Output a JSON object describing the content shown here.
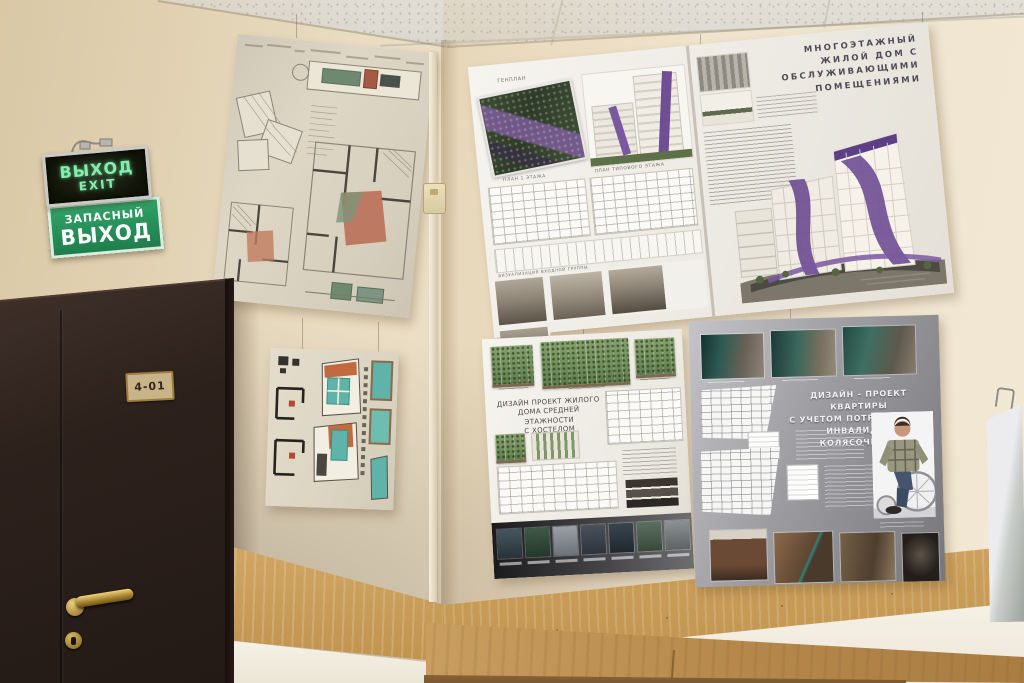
{
  "signs": {
    "exit_box": {
      "line1": "ВЫХОД",
      "line2": "EXIT"
    },
    "emergency": {
      "line1": "ЗАПАСНЫЙ",
      "line2": "ВЫХОД"
    }
  },
  "door": {
    "room_plate": "4-01"
  },
  "boards": {
    "residential": {
      "title_lines": [
        "МНОГОЭТАЖНЫЙ",
        "ЖИЛОЙ ДОМ С",
        "ОБСЛУЖИВАЮЩИМИ",
        "ПОМЕЩЕНИЯМИ"
      ],
      "labels": {
        "genplan": "ГЕНПЛАН",
        "plan_first": "ПЛАН 1 ЭТАЖА",
        "plan_typical": "ПЛАН ТИПОВОГО ЭТАЖА",
        "visualization": "ВИЗУАЛИЗАЦИЯ ВХОДНОЙ ГРУППЫ"
      }
    },
    "hostel": {
      "title_lines": [
        "ДИЗАЙН ПРОЕКТ ЖИЛОГО",
        "ДОМА СРЕДНЕЙ ЭТАЖНОСТИ",
        "С ХОСТЕЛОМ"
      ]
    },
    "apartment": {
      "title_lines": [
        "ДИЗАЙН - ПРОЕКТ КВАРТИРЫ",
        "С УЧЕТОМ ПОТРЕБНОСТЕЙ",
        "ИНВАЛИДА - КОЛЯСОЧНИКА"
      ]
    }
  },
  "colors": {
    "wall": "#ecdfc6",
    "ceiling": "#dad7cf",
    "door": "#2c211c",
    "wood_wainscot": "#c89f5e",
    "cabinet_wood": "#b3854a",
    "sign_green": "#2fa468",
    "sign_text_green": "#8aeab0",
    "accent_purple": "#6f4e94",
    "facade_green": "#7b9465",
    "accent_teal": "#62b0a4",
    "poster_gray": "#9b9b9f",
    "brass": "#c9a254"
  }
}
